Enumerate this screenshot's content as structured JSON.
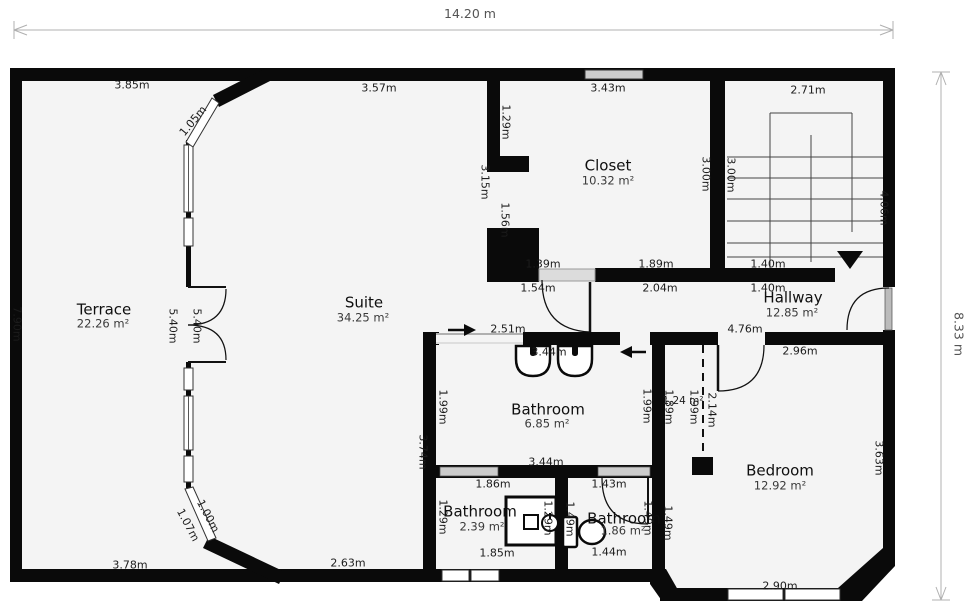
{
  "overall": {
    "width_label": "14.20 m",
    "height_label": "8.33 m"
  },
  "rooms": {
    "terrace": {
      "name": "Terrace",
      "area": "22.26 m²"
    },
    "suite": {
      "name": "Suite",
      "area": "34.25 m²"
    },
    "closet": {
      "name": "Closet",
      "area": "10.32 m²"
    },
    "hallway": {
      "name": "Hallway",
      "area": "12.85 m²"
    },
    "bath_main": {
      "name": "Bathroom",
      "area": "6.85 m²"
    },
    "bath_left": {
      "name": "Bathroom",
      "area": "2.39 m²"
    },
    "bath_right": {
      "name": "Bathroom",
      "area": "1.86 m²"
    },
    "bedroom": {
      "name": "Bedroom",
      "area": "12.92 m²"
    }
  },
  "dims": {
    "terrace_top": "3.85m",
    "terrace_diag_top": "1.05m",
    "suite_top": "3.57m",
    "closet_top": "3.43m",
    "stairs_top": "2.71m",
    "closet_left_upper": "1.29m",
    "closet_left_span": "3.15m",
    "closet_left_window": "1.56m",
    "closet_right": "3.00m",
    "stairs_left": "3.00m",
    "stairs_right": "4.06m",
    "closet_bottom_left_in": "1.39m",
    "closet_bottom_left_out": "1.54m",
    "closet_bottom_in": "1.89m",
    "closet_bottom_out": "2.04m",
    "stairs_bottom_in": "1.40m",
    "stairs_bottom_out": "1.40m",
    "terrace_left": "7.90m",
    "terrace_right": "5.40m",
    "suite_left": "5.40m",
    "bath_top_opening": "2.51m",
    "bath_top_width": "3.44m",
    "hallway_bottom": "4.76m",
    "bedroom_top": "2.96m",
    "bath_left": "1.99m",
    "bath_right": "1.99m",
    "nook_left": "1.89m",
    "nook_area": "1.24 m²",
    "nook_right": "1.99m",
    "nook_dashed": "2.14m",
    "suite_right_lower": "3.74m",
    "bedroom_right": "3.63m",
    "terrace_diag_bottom_out": "1.07m",
    "terrace_diag_bottom_in": "1.00m",
    "terrace_bottom": "3.78m",
    "suite_bottom": "2.63m",
    "bath_bottom": "3.44m",
    "bath2_top": "1.86m",
    "bath2_left": "1.29m",
    "bath2_right": "1.29m",
    "bath2_bottom": "1.85m",
    "bath3_top": "1.43m",
    "bath3_left": "1.49m",
    "bath3_right": "1.49m",
    "bath3_outer": "1.49m",
    "bath3_bottom": "1.44m",
    "bedroom_bottom": "2.90m"
  },
  "colors": {
    "wall": "#0a0a0a",
    "floor": "#f4f4f4",
    "window_glass": "#cccccc",
    "dimension_line": "#b0b0b0"
  }
}
